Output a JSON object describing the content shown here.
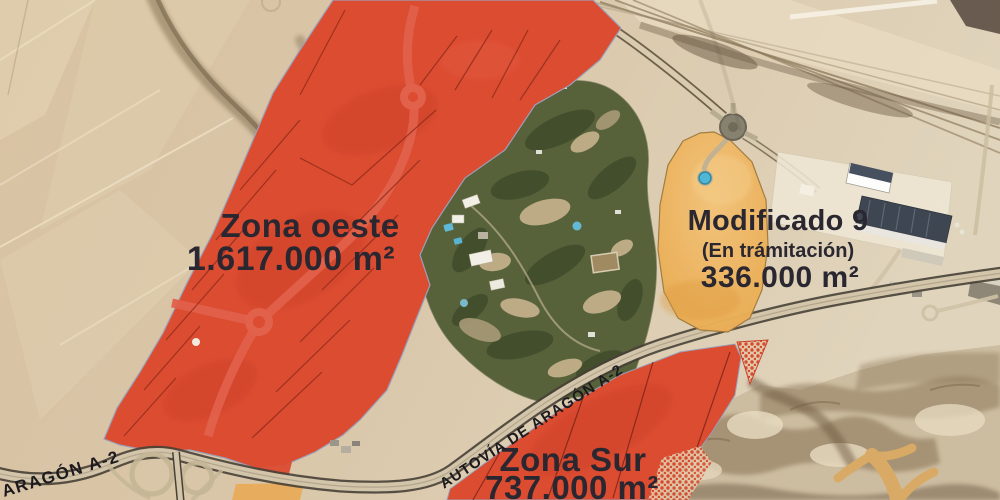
{
  "map": {
    "zones": [
      {
        "id": "zona-oeste",
        "name": "Zona oeste",
        "area": "1.617.000 m²",
        "fill": "#db4c31"
      },
      {
        "id": "modificado-9",
        "name": "Modificado 9",
        "status": "(En trámitación)",
        "area": "336.000 m²",
        "fill": "#eeb058"
      },
      {
        "id": "zona-sur",
        "name": "Zona Sur",
        "area": "737.000 m²",
        "fill": "#db4c31"
      }
    ],
    "roads": {
      "autovia_label": "AUTOVÍA DE ARAGÓN A-2",
      "aragon_label": "ARAGÓN A-2"
    },
    "colors": {
      "zone_red": "#db4c31",
      "zone_orange": "#eeb058",
      "label_text": "#2a2730",
      "desert": "#d8c3a4",
      "golf_green": "#57623a"
    }
  }
}
